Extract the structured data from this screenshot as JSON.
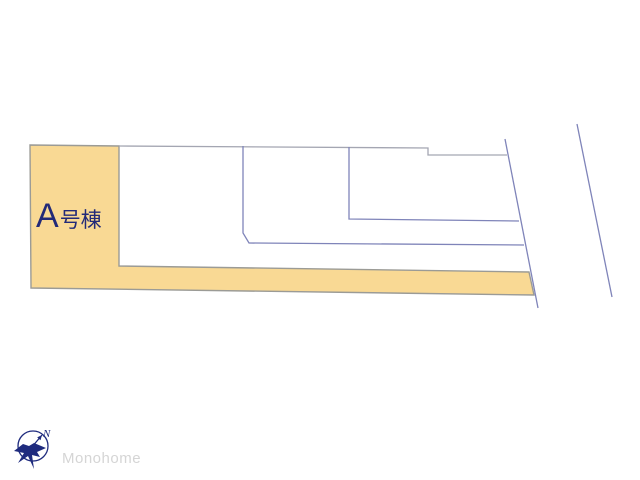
{
  "plan": {
    "building_label": {
      "letter": "A",
      "suffix": "号棟",
      "full_text": "A号棟"
    },
    "colors": {
      "lot_fill": "#F9D994",
      "lot_border": "#9B9B96",
      "line_blue": "#7F84B9",
      "label_navy": "#232A78"
    }
  },
  "compass": {
    "north_label": "N",
    "color": "#1F2B7E"
  },
  "watermark": {
    "text": "Monohome",
    "color": "#D5D5D5"
  }
}
